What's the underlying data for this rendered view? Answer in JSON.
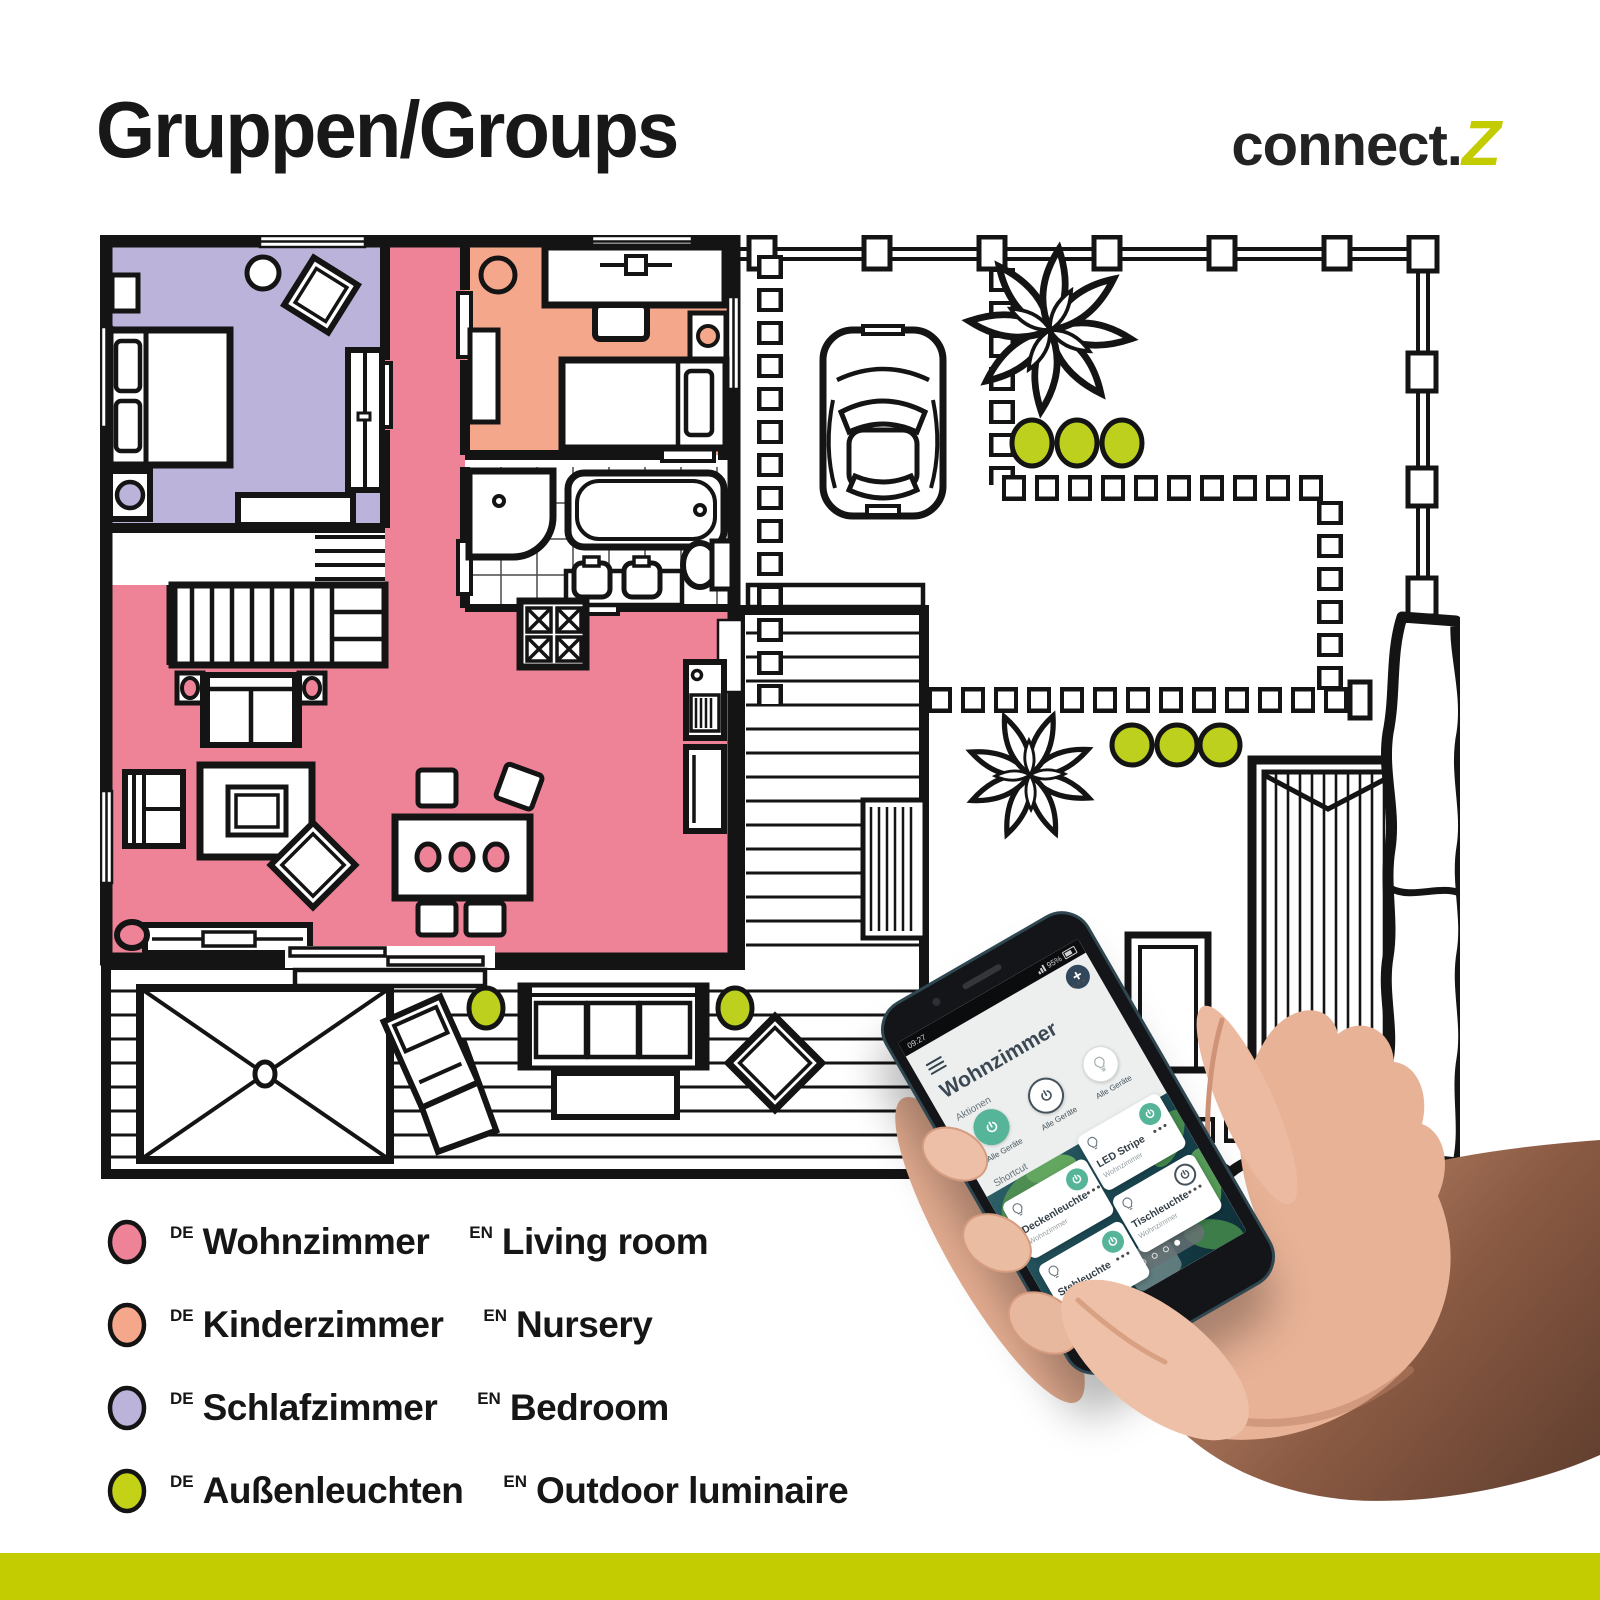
{
  "header": {
    "title": "Gruppen/Groups",
    "brand_prefix": "connect.",
    "brand_accent": "Z"
  },
  "colors": {
    "wall": "#161616",
    "living_room": "#ee8397",
    "nursery": "#f5a78c",
    "bedroom": "#bcb3db",
    "outdoor_light": "#bdd01e",
    "accent_bar": "#c3cc00",
    "phone_green": "#56b598"
  },
  "legend": {
    "items": [
      {
        "name": "living-room",
        "de_tag": "DE",
        "de": "Wohnzimmer",
        "en_tag": "EN",
        "en": "Living room",
        "color": "#ee8397"
      },
      {
        "name": "nursery",
        "de_tag": "DE",
        "de": "Kinderzimmer",
        "en_tag": "EN",
        "en": "Nursery",
        "color": "#f5a78c"
      },
      {
        "name": "bedroom",
        "de_tag": "DE",
        "de": "Schlafzimmer",
        "en_tag": "EN",
        "en": "Bedroom",
        "color": "#bcb3db"
      },
      {
        "name": "outdoor",
        "de_tag": "DE",
        "de": "Außenleuchten",
        "en_tag": "EN",
        "en": "Outdoor luminaire",
        "color": "#c3d117"
      }
    ]
  },
  "phone": {
    "status": {
      "time": "09:27",
      "battery": "95%"
    },
    "app": {
      "title": "Wohnzimmer",
      "actions_label": "Aktionen",
      "actions": [
        {
          "label": "Alle Geräte",
          "state": "on"
        },
        {
          "label": "Alle Geräte",
          "state": "off"
        },
        {
          "label": "Alle Geräte",
          "state": "lamp"
        }
      ],
      "shortcut_label": "Shortcut",
      "cards": [
        {
          "name": "Deckenleuchte",
          "room": "Wohnzimmer",
          "power_on": true
        },
        {
          "name": "LED Stripe",
          "room": "Wohnzimmer",
          "power_on": true
        },
        {
          "name": "Stehleuchte",
          "room": "Wohnzimmer",
          "power_on": true
        },
        {
          "name": "Tischleuchte",
          "room": "Wohnzimmer",
          "power_on": false
        }
      ]
    }
  }
}
